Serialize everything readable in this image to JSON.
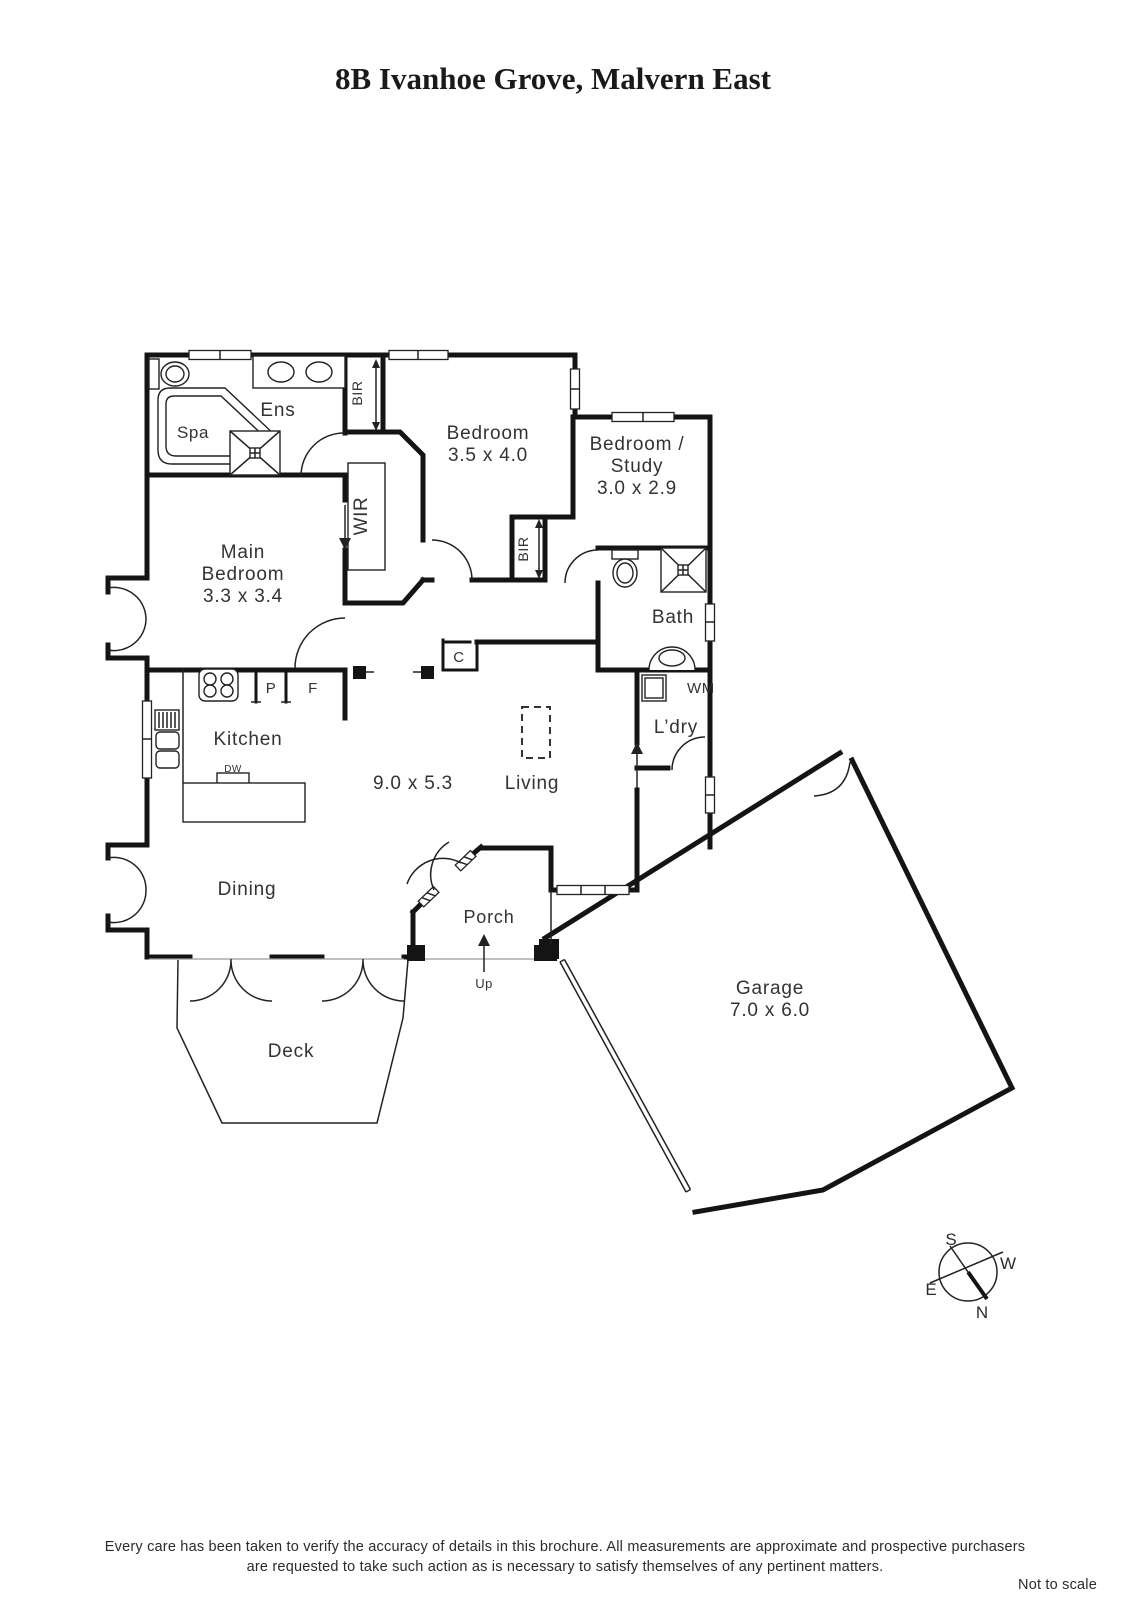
{
  "title": "8B Ivanhoe Grove, Malvern East",
  "rooms": {
    "ens": {
      "name": "Ens"
    },
    "spa": {
      "name": "Spa"
    },
    "main_bedroom": {
      "line1": "Main",
      "line2": "Bedroom",
      "dims": "3.3 x 3.4"
    },
    "bedroom": {
      "name": "Bedroom",
      "dims": "3.5 x 4.0"
    },
    "study": {
      "line1": "Bedroom /",
      "line2": "Study",
      "dims": "3.0 x 2.9"
    },
    "bath": {
      "name": "Bath"
    },
    "laundry": {
      "name": "L’dry"
    },
    "kitchen": {
      "name": "Kitchen"
    },
    "living": {
      "name": "Living",
      "dims": "9.0 x 5.3"
    },
    "dining": {
      "name": "Dining"
    },
    "porch": {
      "name": "Porch"
    },
    "deck": {
      "name": "Deck"
    },
    "garage": {
      "name": "Garage",
      "dims": "7.0 x 6.0"
    }
  },
  "features": {
    "bir_top": "BIR",
    "wir": "WIR",
    "bir_bedroom": "BIR",
    "pantry": "P",
    "fridge": "F",
    "cupboard": "C",
    "dishwasher": "DW",
    "washing_machine": "WM",
    "up": "Up"
  },
  "compass": {
    "n": "N",
    "s": "S",
    "e": "E",
    "w": "W"
  },
  "footer": {
    "line1": "Every care has been taken to verify the accuracy of details in this brochure.  All measurements are approximate and prospective purchasers",
    "line2": "are requested to take such action as is necessary to satisfy themselves of any pertinent matters.",
    "scale": "Not to scale"
  }
}
